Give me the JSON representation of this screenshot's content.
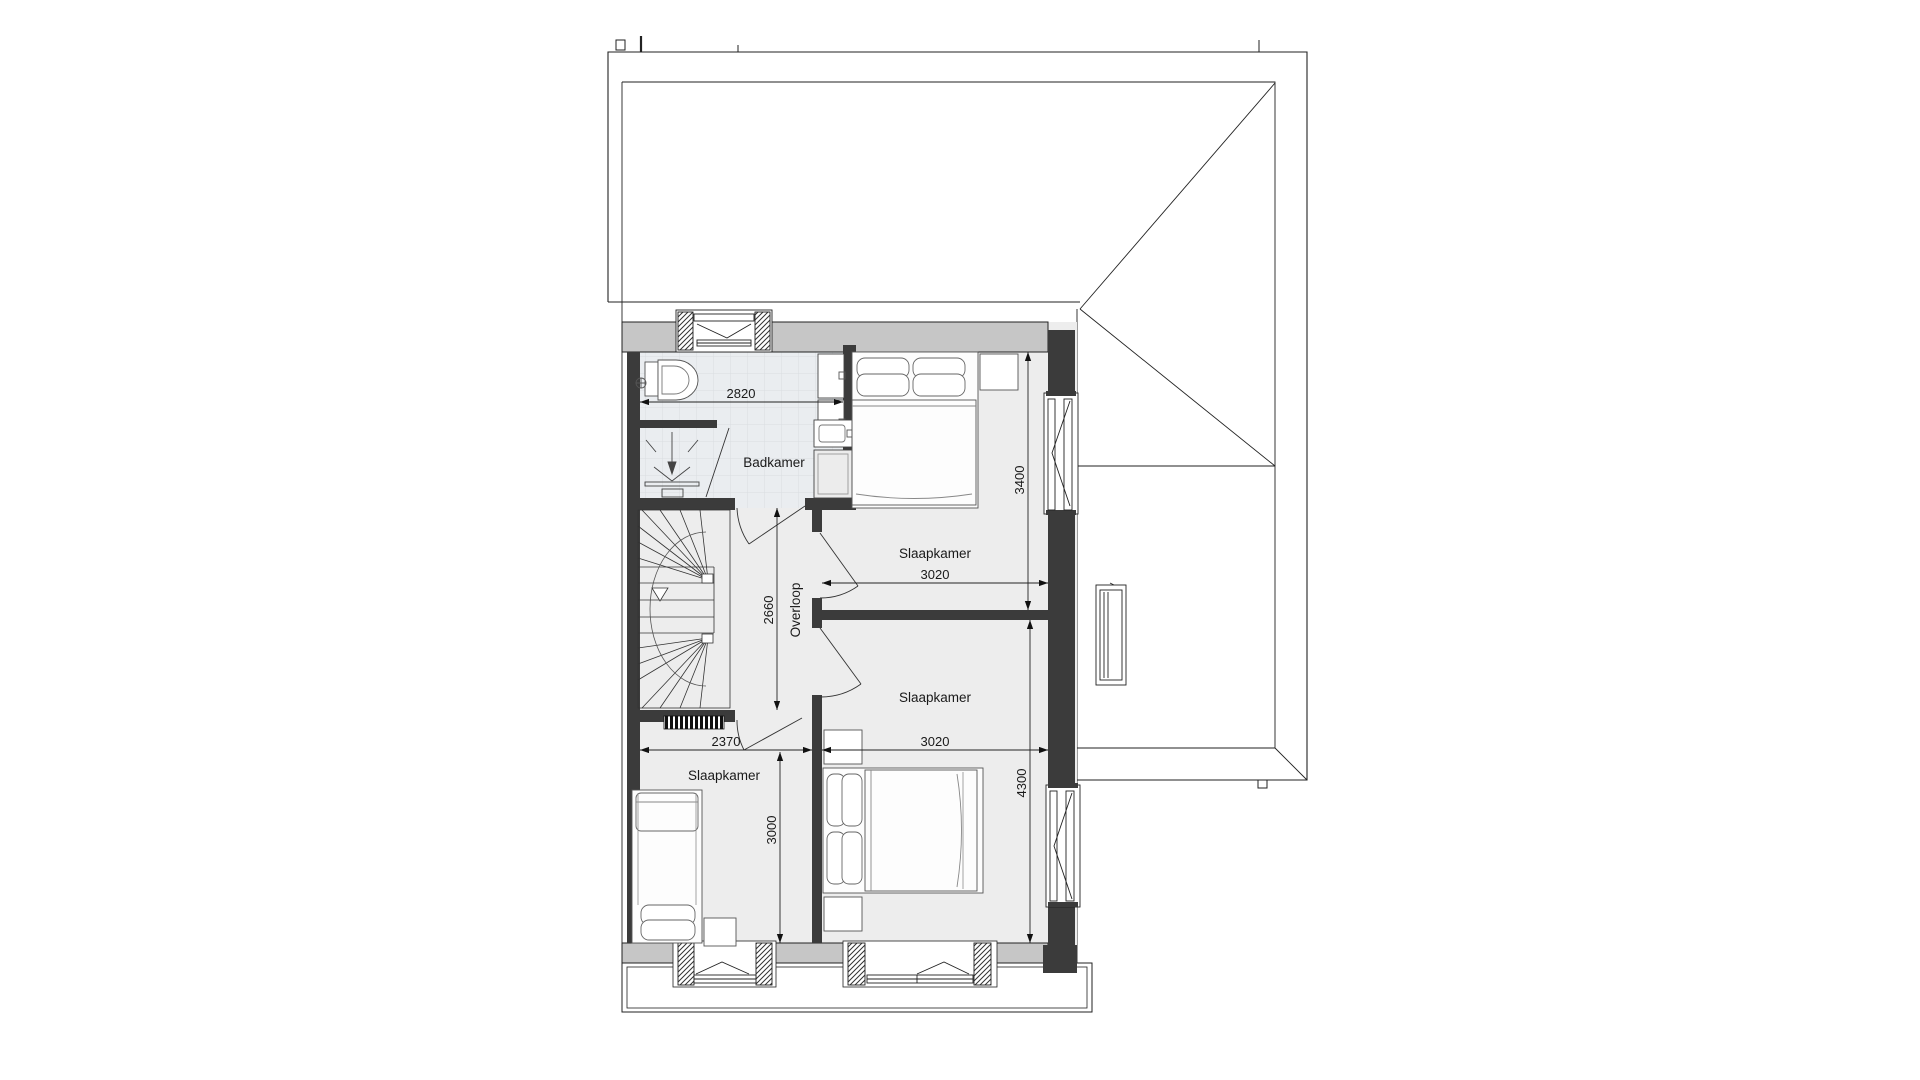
{
  "plan": {
    "type": "floorplan-first-floor",
    "rooms": {
      "bathroom": {
        "label": "Badkamer",
        "width_mm": "2820"
      },
      "bedroom_top_right": {
        "label": "Slaapkamer",
        "width_mm": "3020",
        "depth_mm": "3400"
      },
      "bedroom_mid_right": {
        "label": "Slaapkamer",
        "width_mm": "3020",
        "depth_mm": "4300"
      },
      "bedroom_bottom_left": {
        "label": "Slaapkamer",
        "width_mm": "2370",
        "depth_mm": "3000"
      },
      "landing": {
        "label": "Overloop",
        "depth_mm": "2660"
      }
    },
    "colors": {
      "wall_dark": "#3b3b3b",
      "wall_light": "#c6c6c6",
      "floor": "#ededed",
      "tile_floor": "#eaedf0",
      "line": "#222222"
    }
  }
}
